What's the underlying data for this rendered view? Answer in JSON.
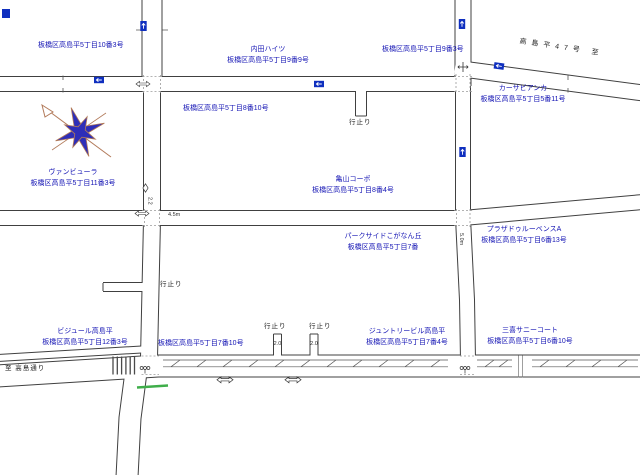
{
  "colors": {
    "label_blue": "#1414b4",
    "note_black": "#1a1a1a",
    "road_casing": "#404040",
    "sign_blue": "#0f2fbf",
    "curb_green": "#3fae4a",
    "compass_fill": "#2e2eb8",
    "compass_stroke": "#b27a5a"
  },
  "icons": {
    "one_way_sign": "↑",
    "two_way_arrow": "⇔",
    "one_way_diamond": "◇",
    "traffic_signal": "signal",
    "compass": "eight-point-star-north-arrow"
  },
  "labels": {
    "addr_5_10_3": "板橋区高島平5丁目10番3号",
    "uchida_name": "内田ハイツ",
    "uchida_addr": "板橋区高島平5丁目9番9号",
    "addr_5_9_3": "板橋区高島平5丁目9番3号",
    "route47": "高島平47号 至",
    "casa_name": "カーサビアンカ",
    "casa_addr": "板橋区高島平5丁目5番11号",
    "addr_5_8_10": "板橋区高島平5丁目8番10号",
    "van_name": "ヴァンビューラ",
    "van_addr": "板橋区高島平5丁目11番3号",
    "kameyama_name": "亀山コーポ",
    "kameyama_addr": "板橋区高島平5丁目8番4号",
    "plaza_name": "プラザドゥルーベンスA",
    "plaza_addr": "板橋区高島平5丁目6番13号",
    "parkside_name": "パークサイドこがなん丘",
    "parkside_addr": "板橋区高島平5丁目7番",
    "bijule_name": "ビジュール高島平",
    "bijule_addr": "板橋区高島平5丁目12番3号",
    "addr_5_7_10": "板橋区高島平5丁目7番10号",
    "junto_name": "ジュントリービル高島平",
    "junto_addr": "板橋区高島平5丁目7番4号",
    "sanki_name": "三喜サニーコート",
    "sanki_addr": "板橋区高島平5丁目6番10号",
    "dead_end": "行止り",
    "to_takashima_dori": "至 高島通り"
  },
  "road_widths": {
    "w1": "4.5m",
    "w2": "5.0m",
    "w3": "2.0",
    "w4": "2.0",
    "w5": "2.2"
  }
}
